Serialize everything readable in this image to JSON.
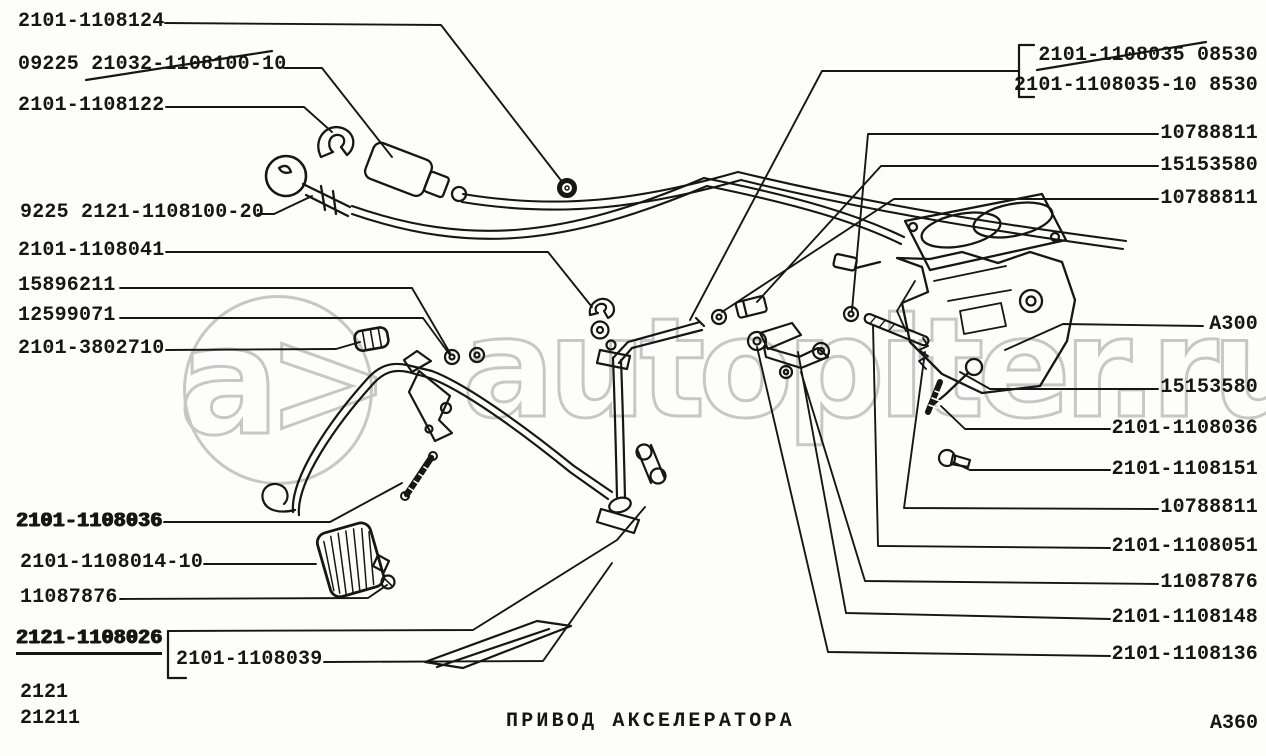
{
  "document": {
    "type": "parts-catalog-diagram",
    "ink_color": "#161616",
    "paper_color": "#fdfdfb",
    "watermark_color": "#c7c7c7"
  },
  "watermark": {
    "logo_text": "a>",
    "text": "autopiter.ru"
  },
  "labels": {
    "left": [
      {
        "text": "2101-1108124",
        "x": 18,
        "y": 12
      },
      {
        "text": "09225 21032-1108100-10",
        "x": 18,
        "y": 55,
        "strike": true
      },
      {
        "text": "2101-1108122",
        "x": 18,
        "y": 96
      },
      {
        "text": "9225 2121-1108100-20",
        "x": 20,
        "y": 203
      },
      {
        "text": "2101-1108041",
        "x": 18,
        "y": 241
      },
      {
        "text": "15896211",
        "x": 18,
        "y": 276
      },
      {
        "text": "12599071",
        "x": 18,
        "y": 306
      },
      {
        "text": "2101-3802710",
        "x": 18,
        "y": 339
      },
      {
        "text": "2101-1108036",
        "x": 16,
        "y": 512,
        "bold": true
      },
      {
        "text": "2101-1108014-10",
        "x": 20,
        "y": 553
      },
      {
        "text": "11087876",
        "x": 20,
        "y": 588
      },
      {
        "text": "2121-1108026",
        "x": 16,
        "y": 629,
        "bold": true,
        "underline": true
      },
      {
        "text": "2101-1108039",
        "x": 176,
        "y": 650
      }
    ],
    "right": [
      {
        "text": "2101-1108035 08530",
        "y": 46,
        "strike": true
      },
      {
        "text": "2101-1108035-10 8530",
        "y": 76
      },
      {
        "text": "10788811",
        "y": 124
      },
      {
        "text": "15153580",
        "y": 156
      },
      {
        "text": "10788811",
        "y": 189
      },
      {
        "text": "A300",
        "y": 315
      },
      {
        "text": "15153580",
        "y": 378
      },
      {
        "text": "2101-1108036",
        "y": 419
      },
      {
        "text": "2101-1108151",
        "y": 460
      },
      {
        "text": "10788811",
        "y": 498
      },
      {
        "text": "2101-1108051",
        "y": 537
      },
      {
        "text": "11087876",
        "y": 573
      },
      {
        "text": "2101-1108148",
        "y": 608
      },
      {
        "text": "2101-1108136",
        "y": 645
      }
    ]
  },
  "footer": {
    "model_codes": [
      "2121",
      "21211"
    ],
    "title": "ПРИВОД АКСЕЛЕРАТОРА",
    "sheet_code": "A360"
  }
}
